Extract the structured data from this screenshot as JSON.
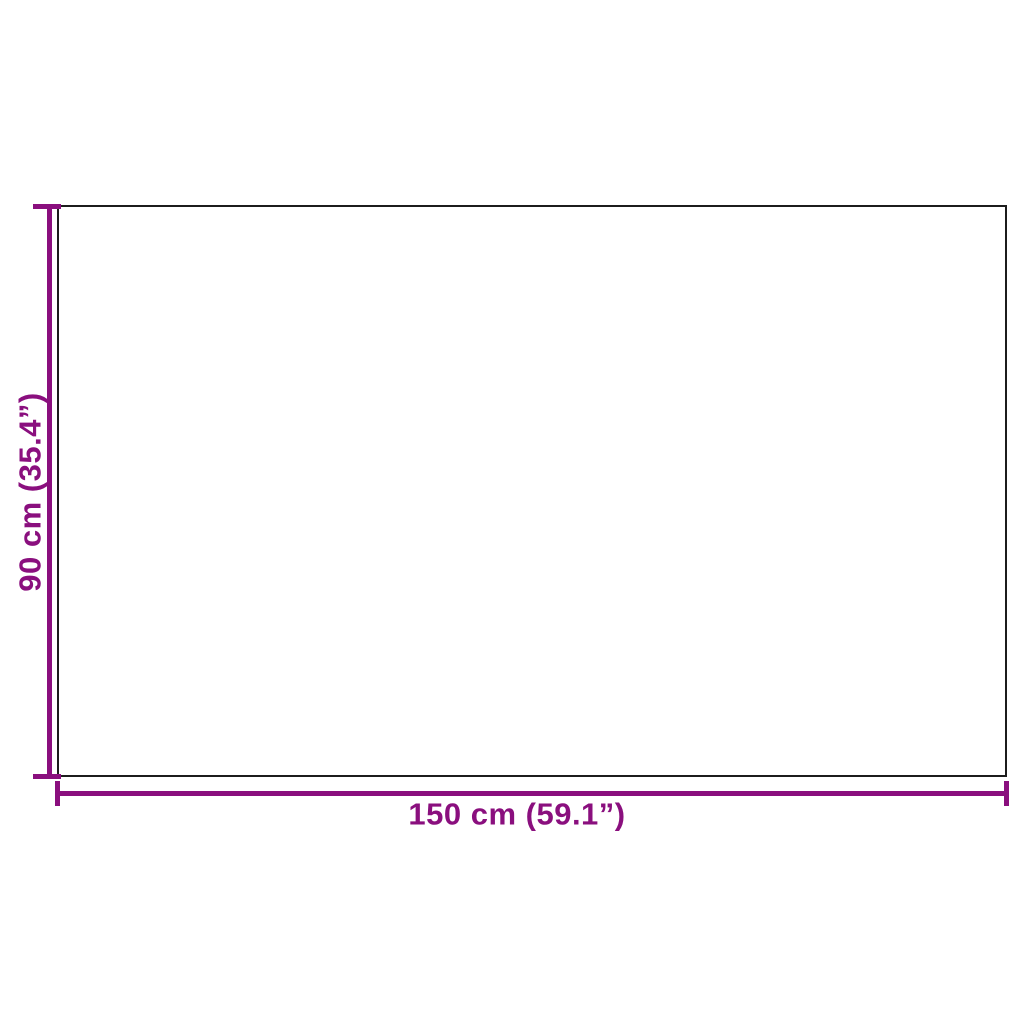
{
  "figure": {
    "background_color": "#ffffff",
    "outline_color": "#1c1c1c",
    "dimension_color": "#8a0f7e",
    "height_dimension": {
      "label": "90 cm (35.4”)",
      "value_cm": 90,
      "value_inch": 35.4
    },
    "width_dimension": {
      "label": "150 cm (59.1”)",
      "value_cm": 150,
      "value_inch": 59.1
    }
  }
}
